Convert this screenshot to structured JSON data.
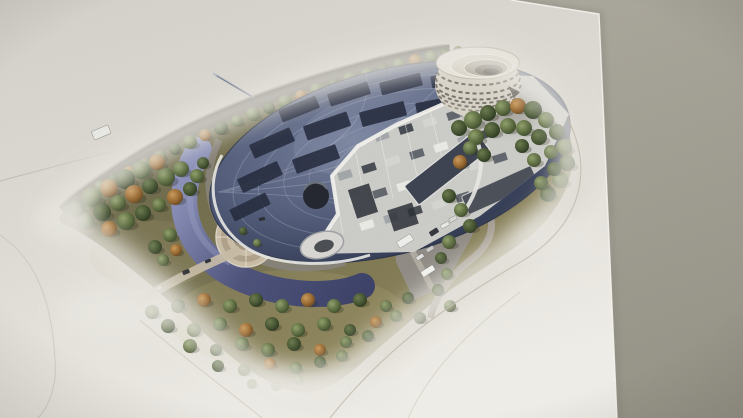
{
  "scene": {
    "kind": "photograph-of-printed-architectural-rendering",
    "subject": "aerial rendering of an elliptical glass-domed facility with cutaway interior machinery, a spiral round annex tower, wooded landscaped grounds, crescent pond, circular plaza and access road, printed on a white sheet photographed at a slight angle on a gray surface"
  },
  "palette": {
    "background": "#a8a59a",
    "background-dark": "#9b988d",
    "paper-top": "#d2d0c9",
    "paper-bottom": "#eeece6",
    "boundary-line": "#c0b9ab",
    "lawn": "#76714e",
    "lawn-light": "#8a8158",
    "road-dark": "#57534c",
    "road-light": "#a59e95",
    "path-beige": "#c6baa5",
    "water-light": "#8a8fb8",
    "water-dark": "#3c4168",
    "dome-light": "#76809b",
    "dome-mid": "#57617e",
    "dome-dark": "#2b3349",
    "panel-dark": "#242a3c",
    "interior-floor": "#cbcbc7",
    "machinery-white": "#e9e9e6",
    "tree-green": "#5c6b3f",
    "tree-dark-green": "#43522f",
    "tree-orange": "#97672f",
    "spiral-body": "#d7d2c6"
  },
  "landscape": {
    "trees_back": [
      [
        100,
        186,
        6,
        "g"
      ],
      [
        114,
        180,
        7,
        "d"
      ],
      [
        129,
        172,
        6,
        "o"
      ],
      [
        145,
        165,
        7,
        "g"
      ],
      [
        160,
        156,
        6,
        "g"
      ],
      [
        175,
        149,
        6,
        "d"
      ],
      [
        190,
        142,
        7,
        "g"
      ],
      [
        205,
        135,
        6,
        "o"
      ],
      [
        221,
        128,
        7,
        "d"
      ],
      [
        237,
        121,
        6,
        "g"
      ],
      [
        253,
        114,
        7,
        "g"
      ],
      [
        269,
        108,
        6,
        "d"
      ],
      [
        285,
        102,
        7,
        "g"
      ],
      [
        301,
        96,
        6,
        "o"
      ],
      [
        317,
        90,
        7,
        "g"
      ],
      [
        334,
        84,
        6,
        "d"
      ],
      [
        350,
        79,
        7,
        "g"
      ],
      [
        367,
        74,
        6,
        "g"
      ],
      [
        383,
        69,
        6,
        "d"
      ],
      [
        399,
        64,
        6,
        "g"
      ],
      [
        415,
        60,
        6,
        "o"
      ],
      [
        431,
        56,
        6,
        "g"
      ],
      [
        445,
        53,
        5,
        "d"
      ],
      [
        458,
        51,
        5,
        "g"
      ],
      [
        76,
        208,
        9,
        "d"
      ],
      [
        92,
        197,
        10,
        "g"
      ],
      [
        109,
        188,
        9,
        "o"
      ],
      [
        125,
        179,
        10,
        "d"
      ],
      [
        141,
        170,
        9,
        "g"
      ],
      [
        157,
        162,
        8,
        "o"
      ],
      [
        86,
        221,
        8,
        "g"
      ],
      [
        102,
        212,
        9,
        "d"
      ],
      [
        118,
        203,
        8,
        "g"
      ],
      [
        134,
        194,
        9,
        "o"
      ],
      [
        150,
        186,
        8,
        "d"
      ],
      [
        166,
        177,
        9,
        "g"
      ],
      [
        181,
        169,
        8,
        "g"
      ],
      [
        109,
        229,
        8,
        "o"
      ],
      [
        126,
        221,
        9,
        "g"
      ],
      [
        143,
        213,
        8,
        "d"
      ],
      [
        159,
        205,
        7,
        "g"
      ],
      [
        175,
        197,
        8,
        "o"
      ],
      [
        190,
        189,
        7,
        "d"
      ],
      [
        170,
        235,
        7,
        "g"
      ],
      [
        155,
        247,
        7,
        "d"
      ],
      [
        176,
        250,
        6,
        "o"
      ],
      [
        163,
        260,
        6,
        "g"
      ],
      [
        197,
        176,
        7,
        "g"
      ],
      [
        203,
        163,
        6,
        "d"
      ]
    ],
    "trees_front": [
      [
        459,
        128,
        8,
        "d"
      ],
      [
        473,
        120,
        9,
        "g"
      ],
      [
        488,
        113,
        8,
        "d"
      ],
      [
        503,
        108,
        8,
        "g"
      ],
      [
        518,
        106,
        8,
        "o"
      ],
      [
        533,
        110,
        9,
        "d"
      ],
      [
        546,
        120,
        8,
        "g"
      ],
      [
        557,
        132,
        8,
        "d"
      ],
      [
        564,
        147,
        8,
        "g"
      ],
      [
        567,
        163,
        8,
        "d"
      ],
      [
        560,
        180,
        8,
        "g"
      ],
      [
        548,
        194,
        8,
        "d"
      ],
      [
        476,
        137,
        8,
        "g"
      ],
      [
        492,
        130,
        8,
        "d"
      ],
      [
        508,
        126,
        8,
        "g"
      ],
      [
        524,
        128,
        8,
        "g"
      ],
      [
        539,
        137,
        8,
        "d"
      ],
      [
        551,
        152,
        7,
        "g"
      ],
      [
        554,
        169,
        7,
        "d"
      ],
      [
        541,
        183,
        7,
        "g"
      ],
      [
        522,
        146,
        7,
        "d"
      ],
      [
        534,
        160,
        7,
        "g"
      ],
      [
        470,
        148,
        7,
        "g"
      ],
      [
        484,
        155,
        7,
        "d"
      ],
      [
        460,
        162,
        7,
        "o"
      ],
      [
        449,
        196,
        7,
        "d"
      ],
      [
        461,
        210,
        7,
        "g"
      ],
      [
        470,
        226,
        7,
        "d"
      ],
      [
        449,
        242,
        7,
        "g"
      ],
      [
        441,
        258,
        6,
        "d"
      ],
      [
        447,
        274,
        6,
        "g"
      ],
      [
        438,
        290,
        6,
        "d"
      ],
      [
        450,
        306,
        6,
        "g"
      ],
      [
        420,
        318,
        6,
        "d"
      ],
      [
        152,
        312,
        7,
        "g"
      ],
      [
        178,
        306,
        7,
        "d"
      ],
      [
        204,
        300,
        7,
        "o"
      ],
      [
        230,
        306,
        7,
        "g"
      ],
      [
        256,
        300,
        7,
        "d"
      ],
      [
        282,
        306,
        7,
        "g"
      ],
      [
        308,
        300,
        7,
        "o"
      ],
      [
        334,
        306,
        7,
        "g"
      ],
      [
        360,
        300,
        7,
        "d"
      ],
      [
        386,
        306,
        6,
        "g"
      ],
      [
        408,
        298,
        6,
        "d"
      ],
      [
        168,
        326,
        7,
        "d"
      ],
      [
        194,
        330,
        7,
        "g"
      ],
      [
        220,
        324,
        7,
        "g"
      ],
      [
        246,
        330,
        7,
        "o"
      ],
      [
        272,
        324,
        7,
        "d"
      ],
      [
        298,
        330,
        7,
        "g"
      ],
      [
        324,
        324,
        7,
        "g"
      ],
      [
        350,
        330,
        6,
        "d"
      ],
      [
        376,
        322,
        6,
        "o"
      ],
      [
        396,
        316,
        6,
        "g"
      ],
      [
        190,
        346,
        7,
        "g"
      ],
      [
        216,
        350,
        6,
        "d"
      ],
      [
        242,
        344,
        7,
        "g"
      ],
      [
        268,
        350,
        7,
        "g"
      ],
      [
        294,
        344,
        7,
        "d"
      ],
      [
        320,
        350,
        6,
        "o"
      ],
      [
        346,
        342,
        6,
        "g"
      ],
      [
        368,
        336,
        6,
        "d"
      ],
      [
        218,
        366,
        6,
        "d"
      ],
      [
        244,
        370,
        6,
        "g"
      ],
      [
        270,
        364,
        6,
        "o"
      ],
      [
        296,
        368,
        6,
        "g"
      ],
      [
        320,
        362,
        6,
        "d"
      ],
      [
        342,
        356,
        6,
        "g"
      ],
      [
        252,
        384,
        5,
        "g"
      ],
      [
        276,
        386,
        5,
        "d"
      ],
      [
        298,
        380,
        5,
        "g"
      ],
      [
        243,
        231,
        4,
        "d"
      ],
      [
        257,
        243,
        4,
        "g"
      ]
    ]
  },
  "vehicles": [
    [
      405,
      241,
      16,
      7,
      -32,
      "#ededeb"
    ],
    [
      428,
      271,
      14,
      6,
      -32,
      "#f2f2f0"
    ],
    [
      434,
      232,
      9,
      5,
      -32,
      "#34373d"
    ],
    [
      445,
      225,
      9,
      4,
      -28,
      "#e8e8e6"
    ],
    [
      453,
      219,
      8,
      4,
      -28,
      "#d9d9d7"
    ],
    [
      430,
      249,
      8,
      4,
      -32,
      "#c9cbc8"
    ],
    [
      420,
      257,
      8,
      4,
      -32,
      "#e2e2e0"
    ],
    [
      186,
      272,
      7,
      4,
      -22,
      "#2e3136"
    ],
    [
      159,
      288,
      6,
      4,
      -22,
      "#e4e4e2"
    ],
    [
      208,
      261,
      6,
      3,
      -22,
      "#30333a"
    ],
    [
      262,
      219,
      6,
      3,
      -12,
      "#2b2e33"
    ]
  ],
  "dome": {
    "skylight_panels": [
      [
        299,
        109,
        40,
        13,
        -22
      ],
      [
        349,
        94,
        42,
        13,
        -18
      ],
      [
        401,
        84,
        42,
        13,
        -14
      ],
      [
        451,
        79,
        40,
        12,
        -10
      ],
      [
        272,
        143,
        44,
        15,
        -24
      ],
      [
        327,
        126,
        46,
        15,
        -19
      ],
      [
        383,
        114,
        46,
        15,
        -15
      ],
      [
        438,
        106,
        44,
        14,
        -11
      ],
      [
        260,
        177,
        44,
        15,
        -25
      ],
      [
        316,
        159,
        46,
        15,
        -20
      ],
      [
        250,
        207,
        40,
        13,
        -26
      ]
    ]
  }
}
